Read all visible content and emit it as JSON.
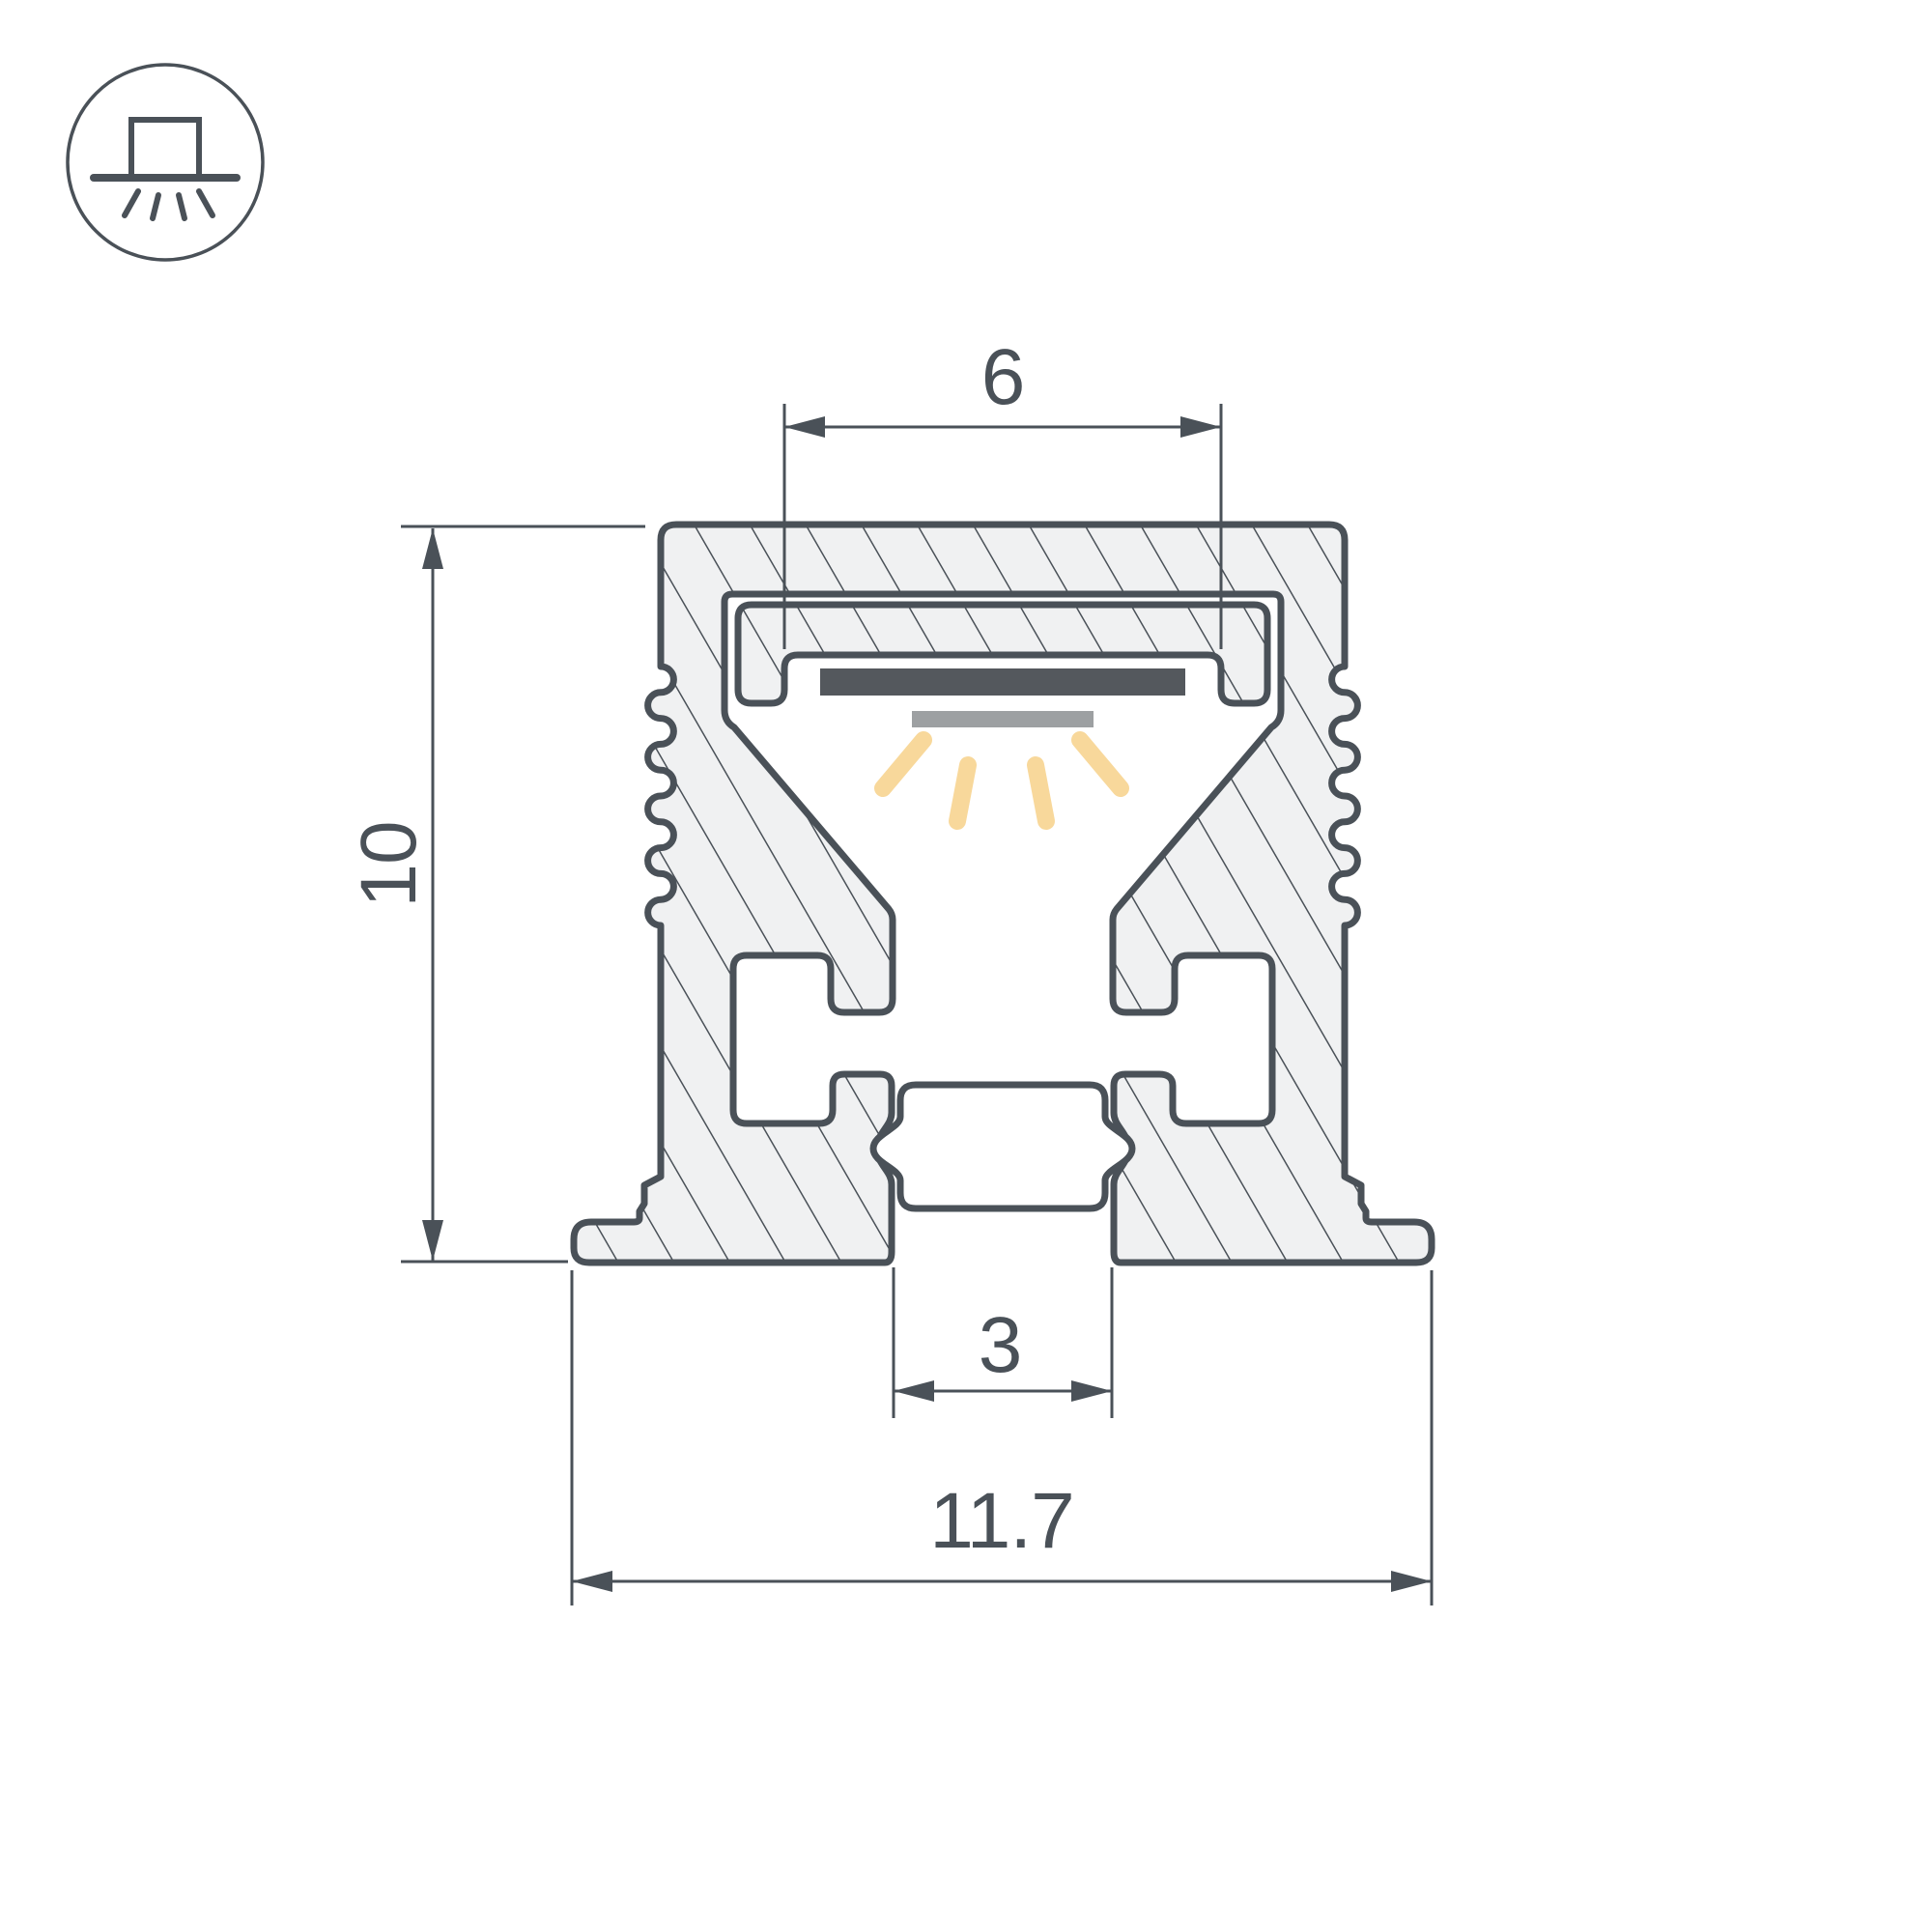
{
  "page": {
    "title": "LED profile cross-section technical drawing",
    "background": "#ffffff"
  },
  "icon_badge": {
    "name": "surface-mounted-luminaire-icon",
    "description": "circle badge with box on mounting line emitting light downward",
    "ray_count": 4
  },
  "drawing": {
    "type": "technical-section",
    "subject": "aluminium LED profile cross-section with LED strip and light rays",
    "colors": {
      "line": "#4a5158",
      "metal_fill": "#f0f1f2",
      "led_strip": "#54585d",
      "diffuser": "#9da0a2",
      "light_ray": "#f8d89b"
    },
    "dimensions": {
      "channel_width": {
        "label": "6"
      },
      "height": {
        "label": "10"
      },
      "slot_width": {
        "label": "3"
      },
      "overall_width": {
        "label": "11.7"
      }
    }
  }
}
